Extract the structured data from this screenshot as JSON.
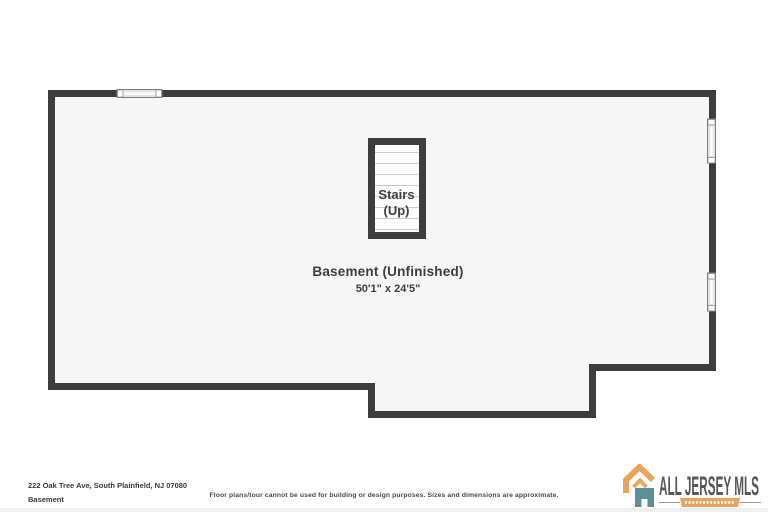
{
  "floor_plan": {
    "room": {
      "label": "Basement (Unfinished)",
      "dimensions": "50'1\" x 24'5\""
    },
    "stairs": {
      "line1": "Stairs",
      "line2": "(Up)"
    }
  },
  "footer": {
    "address": "222 Oak Tree Ave, South Plainfield, NJ 07080",
    "floor_name": "Basement",
    "disclaimer": "Floor plans/tour cannot be used for building or design purposes. Sizes and dimensions are approximate.",
    "logo": {
      "name": "ALL JERSEY MLS"
    }
  },
  "colors": {
    "wall": "#3d3d3d",
    "floor_fill": "#f6f6f6",
    "stair_tread_line": "#cccccc",
    "label_text": "#3e3e3e",
    "logo_orange": "#e9a55d",
    "logo_teal": "#5d8f96",
    "logo_text": "#57585a"
  }
}
